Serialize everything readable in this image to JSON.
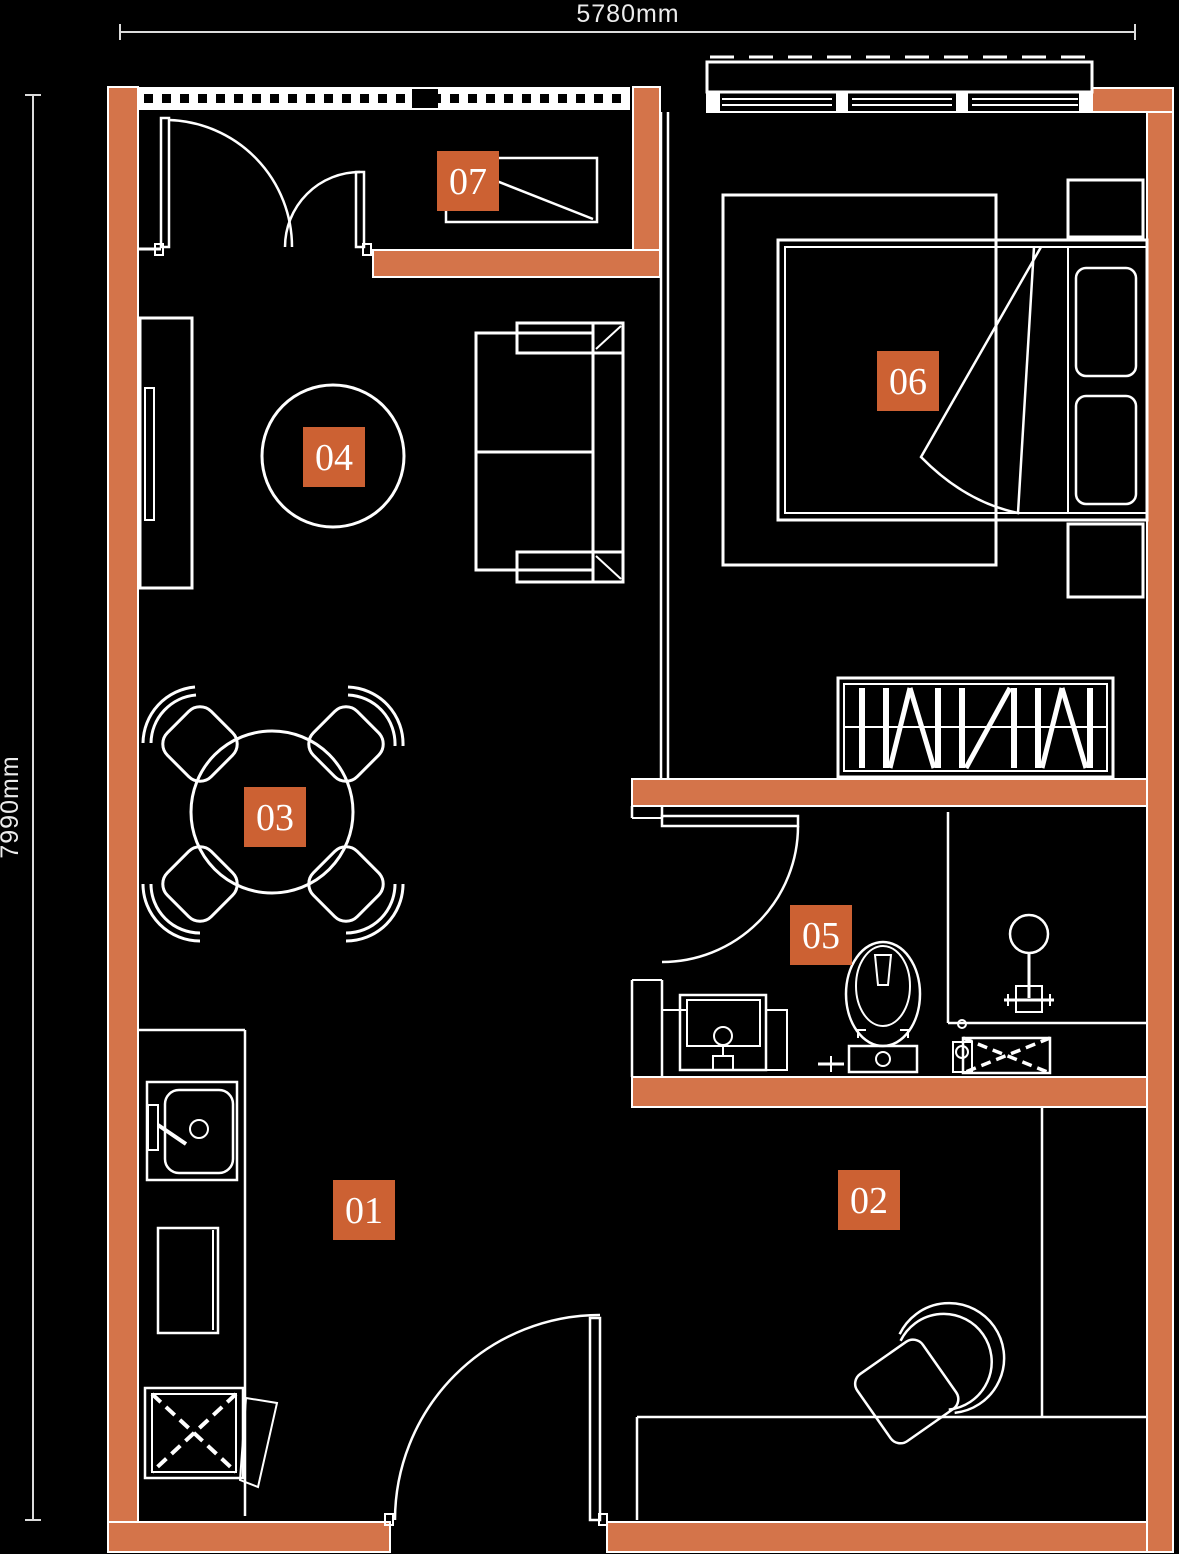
{
  "plan": {
    "dimensions": {
      "width_label": "5780mm",
      "height_label": "7990mm"
    },
    "rooms": [
      {
        "number": "01"
      },
      {
        "number": "02"
      },
      {
        "number": "03"
      },
      {
        "number": "04"
      },
      {
        "number": "05"
      },
      {
        "number": "06"
      },
      {
        "number": "07"
      }
    ],
    "colors": {
      "background": "#000000",
      "wall": "#d4744a",
      "label": "#cc6133",
      "line": "#ffffff"
    }
  }
}
